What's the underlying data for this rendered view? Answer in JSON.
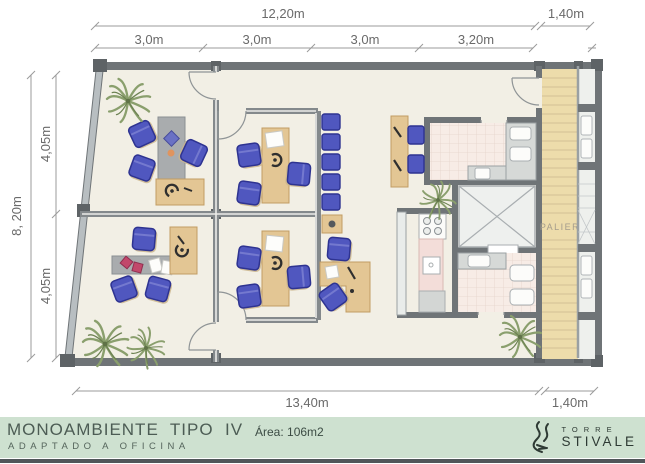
{
  "dimensions": {
    "top_total": "12,20m",
    "top_right": "1,40m",
    "top_segments": [
      "3,0m",
      "3,0m",
      "3,0m",
      "3,20m"
    ],
    "left_total": "8, 20m",
    "left_segments": [
      "4,05m",
      "4,05m"
    ],
    "bottom_total": "13,40m",
    "bottom_right": "1,40m"
  },
  "plan": {
    "palier_label": "PALIER"
  },
  "footer": {
    "title": "MONOAMBIENTE  TIPO  IV",
    "subtitle": "ADAPTADO A OFICINA",
    "area_label": "Área: 106m2",
    "logo_line1": "TORRE",
    "logo_line2": "STIVALE"
  },
  "colors": {
    "floor": "#f2efe5",
    "wall_dark": "#6f7477",
    "wall_light": "#b8bec1",
    "chair_blue": "#5057bf",
    "desk_tan": "#e3c694",
    "table_gray": "#a9acae",
    "stairs_beige": "#eddcab",
    "tile_pink": "#f7ece6",
    "footer_green": "#cee1d0",
    "plant_green": "#8a9f6d"
  }
}
